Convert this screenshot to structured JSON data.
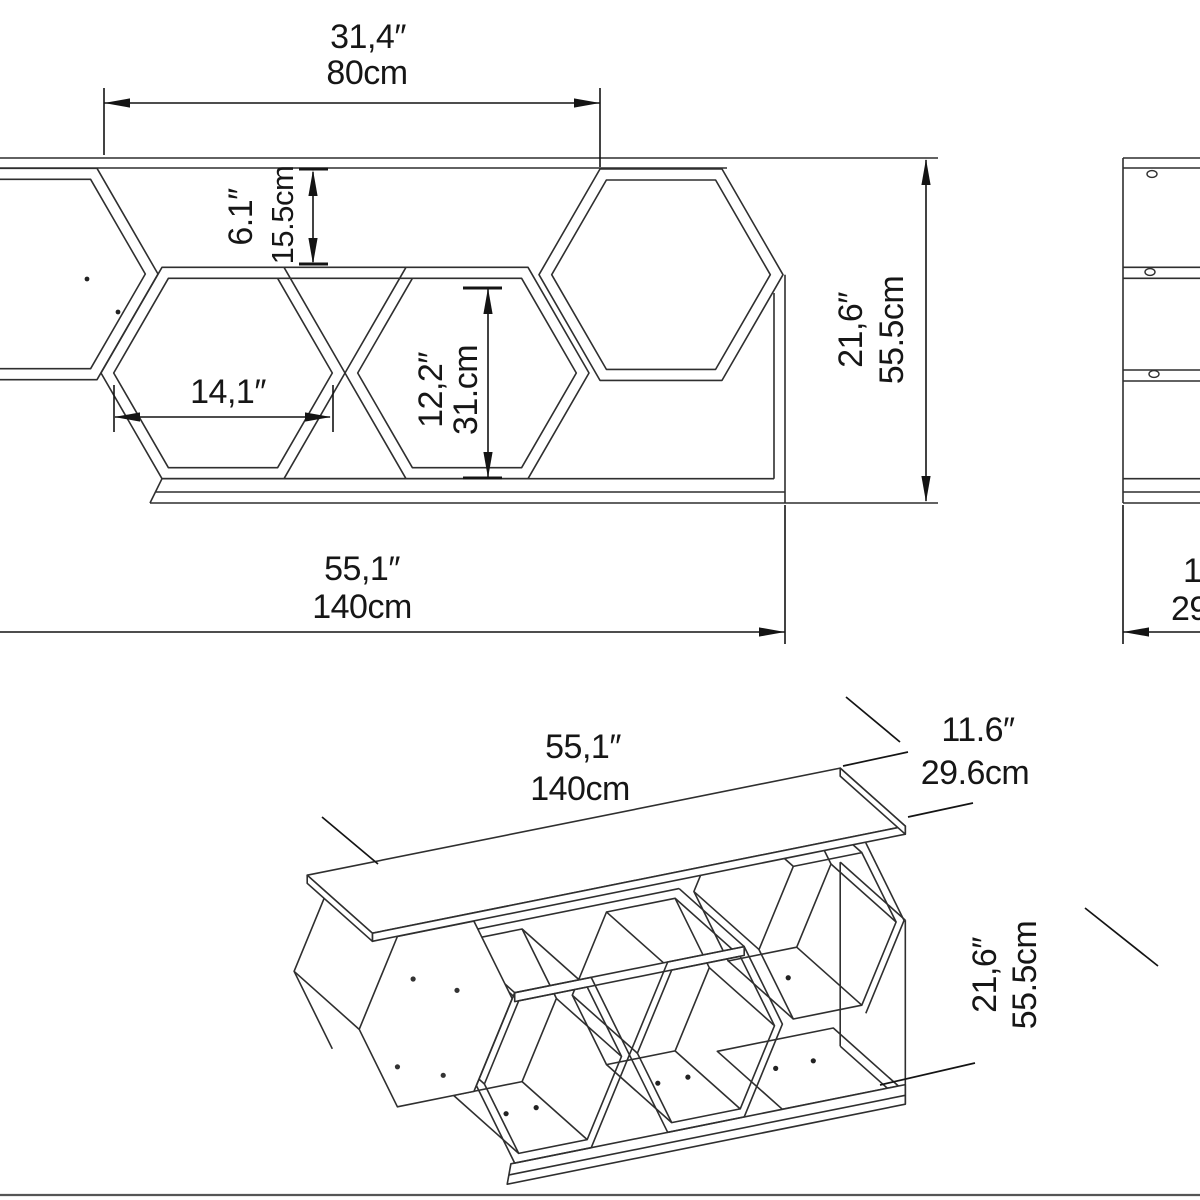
{
  "drawing": {
    "type": "furniture-dimension-drawing",
    "product": "hexagon honeycomb wall shelf / tv unit",
    "units": [
      "inches",
      "centimeters"
    ],
    "colors": {
      "background": "#ffffff",
      "line": "#2f2f2f",
      "dimension": "#141414",
      "border": "#555555"
    },
    "front_view": {
      "dims": {
        "top_opening": {
          "in": "31,4″",
          "cm": "80cm"
        },
        "upper_gap": {
          "in": "6.1″",
          "cm": "15.5cm"
        },
        "hex_width": {
          "in": "14,1″"
        },
        "hex_height": {
          "in": "12,2″",
          "cm": "31.cm"
        },
        "total_height": {
          "in": "21,6″",
          "cm": "55.5cm"
        },
        "total_width": {
          "in": "55,1″",
          "cm": "140cm"
        }
      }
    },
    "side_view": {
      "dims": {
        "depth": {
          "in": "11.6″",
          "cm": "29.6cm"
        }
      }
    },
    "iso_view": {
      "dims": {
        "total_width": {
          "in": "55,1″",
          "cm": "140cm"
        },
        "depth": {
          "in": "11.6″",
          "cm": "29.6cm"
        },
        "total_height": {
          "in": "21,6″",
          "cm": "55.5cm"
        }
      }
    }
  }
}
